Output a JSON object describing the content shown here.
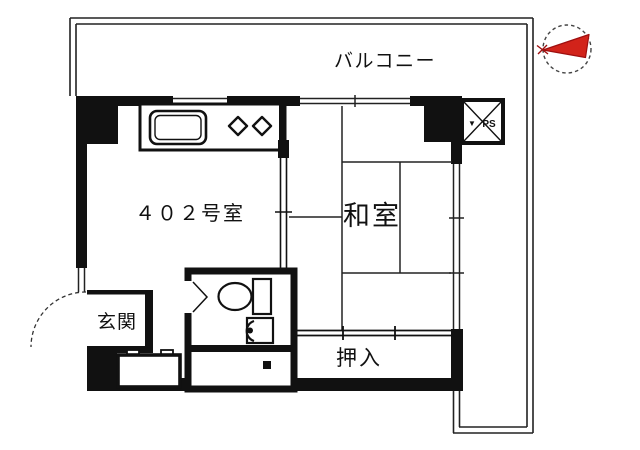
{
  "plan": {
    "type": "apartment-floor-plan",
    "labels": {
      "balcony": "バルコニー",
      "room_number": "４０２号室",
      "japanese_room": "和室",
      "closet": "押入",
      "entrance": "玄関",
      "pipe_space": "PS",
      "pipe_space_mark": "▼"
    },
    "rooms": [
      {
        "name": "balcony",
        "label": "バルコニー",
        "position": "top-and-right-L-shape"
      },
      {
        "name": "main-room",
        "label": "４０２号室",
        "position": "left-center",
        "features": [
          "kitchen-counter",
          "sink",
          "two-burner-stove"
        ]
      },
      {
        "name": "japanese-room",
        "label": "和室",
        "position": "right-center",
        "features": [
          "six-tatami-grid",
          "window-wall-right",
          "sliding-door-to-main-room"
        ]
      },
      {
        "name": "closet",
        "label": "押入",
        "position": "bottom-right",
        "features": [
          "fusuma-sliding-doors"
        ]
      },
      {
        "name": "entrance",
        "label": "玄関",
        "position": "bottom-left",
        "features": [
          "outward-swing-door-arc",
          "shoe-cabinet"
        ]
      },
      {
        "name": "bathroom",
        "label": "",
        "position": "bottom-center",
        "features": [
          "toilet",
          "washbasin",
          "bath-section",
          "inward-door"
        ]
      },
      {
        "name": "pipe-space",
        "label": "PS",
        "position": "top-right",
        "features": [
          "x-crossed-box"
        ]
      }
    ],
    "compass": {
      "style": "red-arrow-in-dashed-circle",
      "arrow_points": "left"
    },
    "colors": {
      "wall": "#111111",
      "line": "#222222",
      "background": "#ffffff",
      "compass_red": "#d2231a",
      "compass_red_dark": "#9e0f0f"
    }
  }
}
